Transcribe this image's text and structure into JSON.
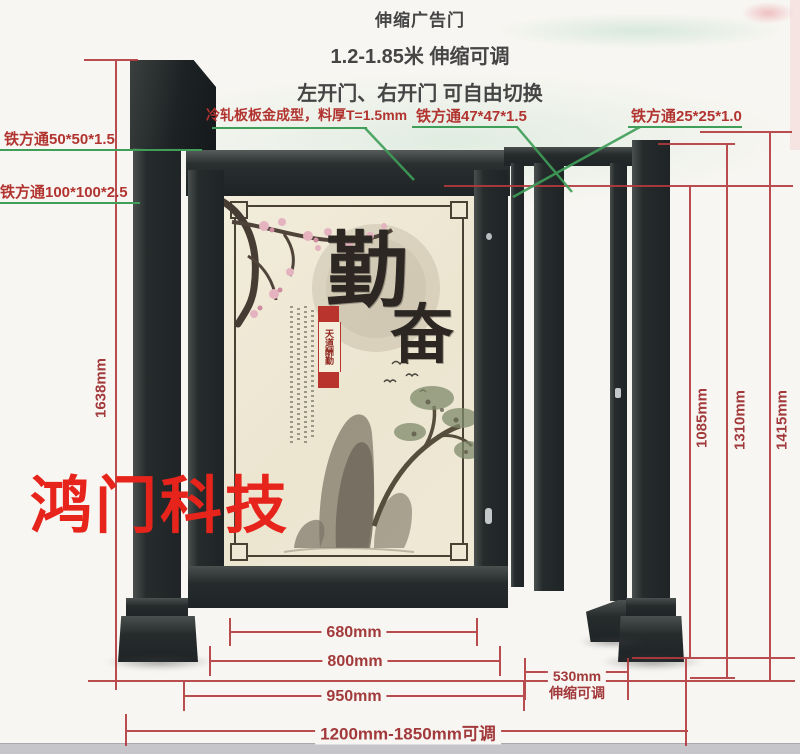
{
  "title": {
    "line1": "伸缩广告门",
    "line2": "1.2-1.85米 伸缩可调",
    "line3": "左开门、右开门 可自由切换"
  },
  "callouts": {
    "tube50": "铁方通50*50*1.5",
    "tube100": "铁方通100*100*2.5",
    "cold_plate": "冷轧板板金成型，料厚T=1.5mm",
    "tube47": "铁方通47*47*1.5",
    "tube25": "铁方通25*25*1.0"
  },
  "dimensions": {
    "total_height_left": "1638mm",
    "opening_height": "1085mm",
    "mid_height": "1310mm",
    "post_height": "1415mm",
    "panel_width": "680mm",
    "door_width": "800mm",
    "door_outer_width": "950mm",
    "extension_width": "530mm",
    "extension_note": "伸缩可调",
    "total_width": "1200mm-1850mm可调"
  },
  "poster": {
    "calligraphy_char1": "勤",
    "calligraphy_char2": "奋",
    "seal_text": "天道酬勤"
  },
  "watermark": "鸿门科技",
  "colors": {
    "dimension_red": "#a23a3c",
    "leader_green": "#3f9e58",
    "callout_red": "#b23430",
    "metal_dark": "#24292b",
    "panel_cream": "#efe8d5",
    "watermark_red": "#e7241b"
  }
}
